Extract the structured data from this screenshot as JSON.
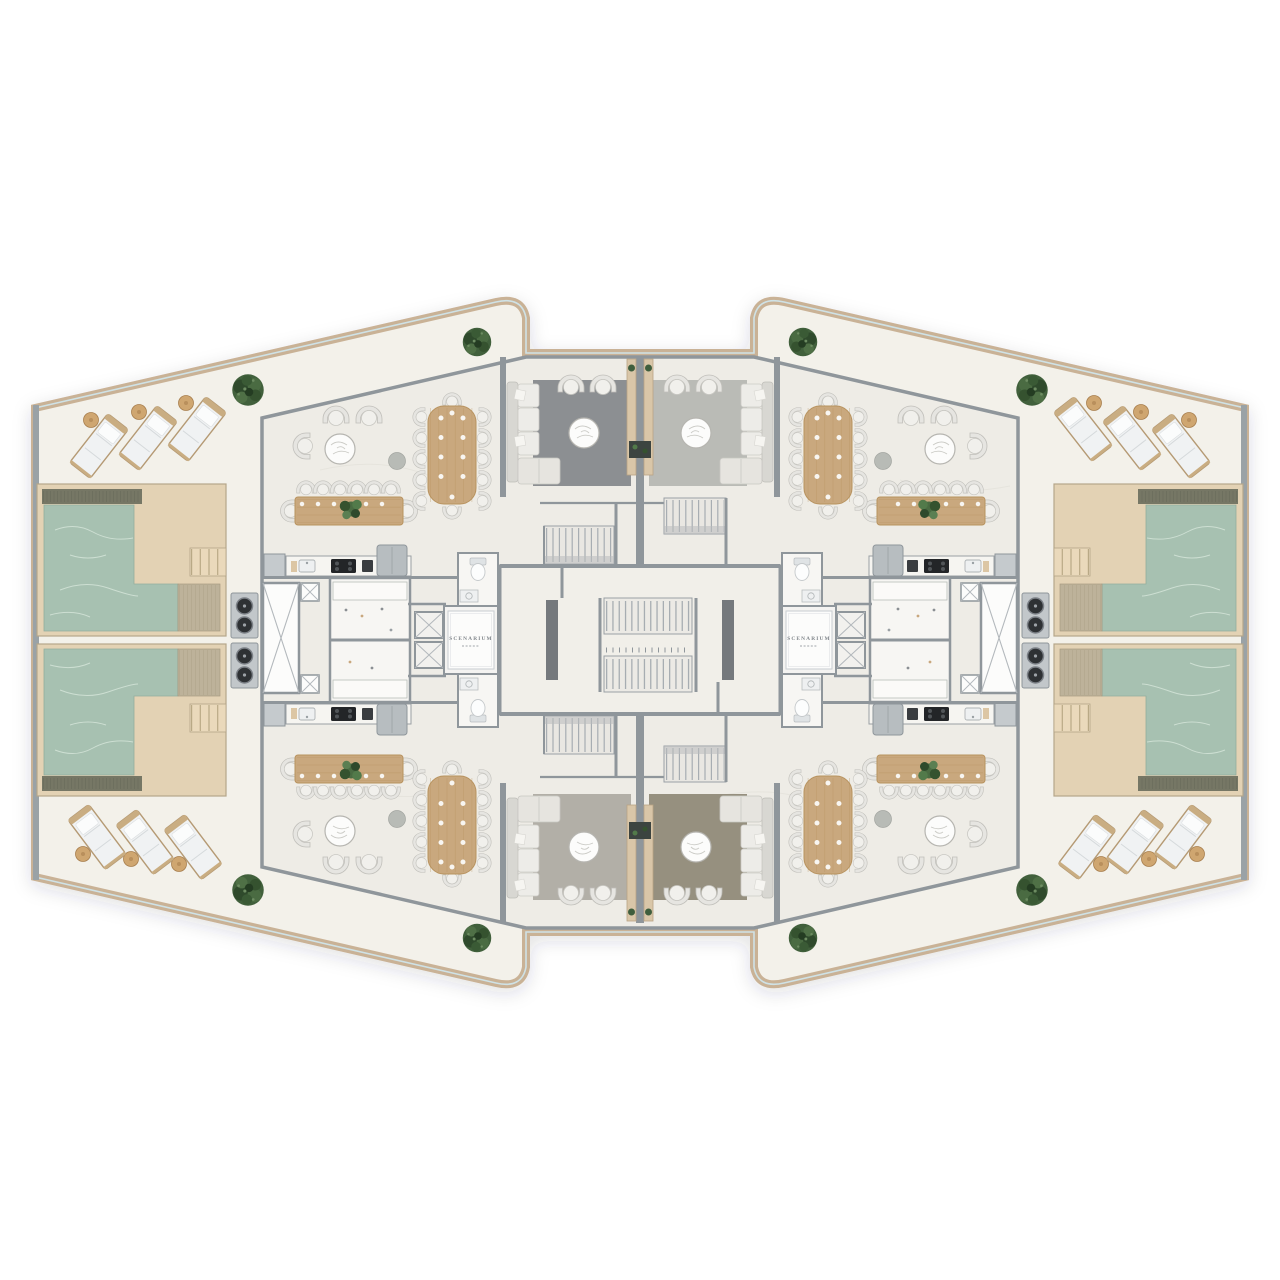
{
  "page": {
    "title": "Penthouse floor plan – top view render",
    "background": "#ffffff"
  },
  "branding": {
    "logo_text": "SCENARIUM",
    "logo_mats_visible": 2
  },
  "palette": {
    "page_bg": "#ffffff",
    "terrace_floor": "#f3f1ea",
    "unit_floor": "#eeece6",
    "wall": "#8f969b",
    "outer_trim": "#c9b296",
    "glass": "#cfe2e6",
    "pool_water": "#a7c1b1",
    "pool_deck": "#e3d2b4",
    "pool_shelf": "#bdb29a",
    "pool_dark_edge": "#767765",
    "wood": "#c9a87e",
    "wood_line": "#b8935f",
    "upholstery": "#edece8",
    "rug_top_left": "#8c8f92",
    "rug_top_right": "#babbb6",
    "rug_bottom_left": "#b2afa7",
    "rug_bottom_right": "#96907f",
    "tree_green": "#41603c",
    "grill_dark": "#2e3134",
    "stair_tread": "#a7adb2",
    "marble": "#fcfcfb"
  },
  "inventory": {
    "pools": 4,
    "sun_loungers": 12,
    "lounger_side_tables": 12,
    "trees": 8,
    "large_dining_tables": 4,
    "long_dining_tables": 4,
    "living_rooms": 4,
    "sofas": 4,
    "armchair_clusters": 4,
    "round_marble_tables": 8,
    "kitchens": 4,
    "bathrooms": 4,
    "elevators": 4,
    "elevator_shafts": 2,
    "grill_stations": 4,
    "unit_staircases": 4,
    "core_staircase": 1,
    "planter_dividers": 2
  }
}
